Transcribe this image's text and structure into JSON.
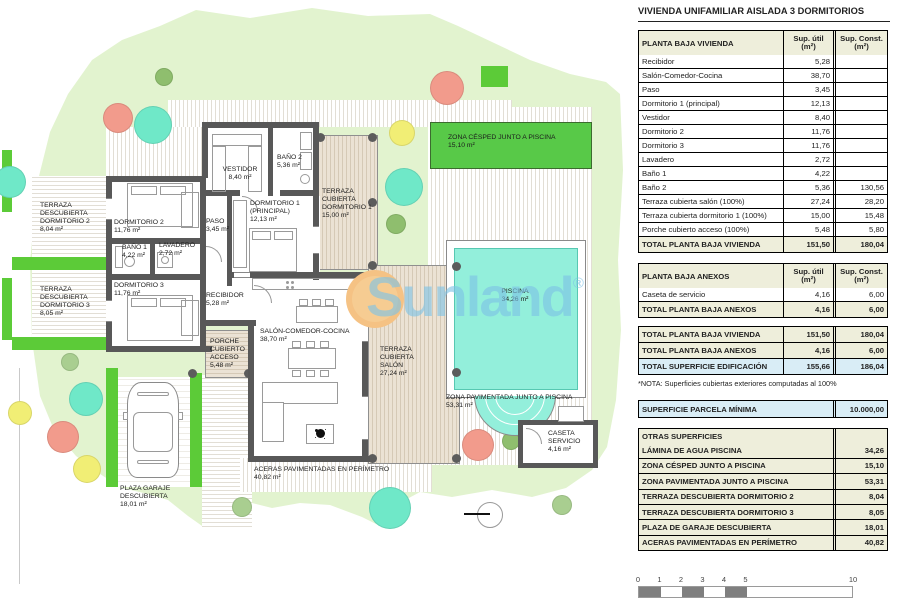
{
  "colors": {
    "garden_green": "#E2F3CF",
    "hedge_green": "#5CCB38",
    "cesped_green": "#58C948",
    "pool_aqua": "#93EFDB",
    "wall_gray": "#585858",
    "tree_salmon": "#F29B8C",
    "tree_teal": "#6FE8C8",
    "tree_yellow": "#F1EE75",
    "tree_green": "#8FBE6E",
    "tree_palegreen": "#A9CE90",
    "table_head_bg": "#EEEEDB",
    "table_highlight_bg": "#D9EDF6",
    "watermark_blue": "#7EC3E6",
    "watermark_orange": "#F6CC92",
    "scale_fill": "#7F7F7F"
  },
  "watermark": {
    "text": "Sunland",
    "reg": "®"
  },
  "plan": {
    "labels": {
      "terraza_desc_dorm2": {
        "name": "TERRAZA\nDESCUBIERTA\nDORMITORIO 2",
        "area": "8,04 m²"
      },
      "terraza_desc_dorm3": {
        "name": "TERRAZA\nDESCUBIERTA\nDORMITORIO 3",
        "area": "8,05 m²"
      },
      "dormitorio2": {
        "name": "DORMITORIO 2",
        "area": "11,76 m²"
      },
      "bano1": {
        "name": "BAÑO 1",
        "area": "4,22 m²"
      },
      "lavadero": {
        "name": "LAVADERO",
        "area": "2,72 m²"
      },
      "dormitorio3": {
        "name": "DORMITORIO 3",
        "area": "11,76 m²"
      },
      "vestidor": {
        "name": "VESTIDOR",
        "area": "8,40 m²"
      },
      "bano2": {
        "name": "BAÑO 2",
        "area": "5,36 m²"
      },
      "paso": {
        "name": "PASO",
        "area": "3,45 m²"
      },
      "dormitorio1": {
        "name": "DORMITORIO 1\n(PRINCIPAL)",
        "area": "12,13 m²"
      },
      "terraza_cub_dorm1": {
        "name": "TERRAZA\nCUBIERTA\nDORMITORIO 1",
        "area": "15,00 m²"
      },
      "recibidor": {
        "name": "RECIBIDOR",
        "area": "5,28 m²"
      },
      "salon": {
        "name": "SALÓN-COMEDOR-COCINA",
        "area": "38,70 m²"
      },
      "terraza_cub_salon": {
        "name": "TERRAZA\nCUBIERTA\nSALÓN",
        "area": "27,24 m²"
      },
      "porche": {
        "name": "PORCHE\nCUBIERTO\nACCESO",
        "area": "5,48 m²"
      },
      "plaza_garaje": {
        "name": "PLAZA GARAJE\nDESCUBIERTA",
        "area": "18,01 m²"
      },
      "aceras": {
        "name": "ACERAS PAVIMENTADAS EN PERÍMETRO",
        "area": "40,82 m²"
      },
      "zona_cesped": {
        "name": "ZONA CÉSPED JUNTO A PISCINA",
        "area": "15,10 m²"
      },
      "piscina": {
        "name": "PISCINA",
        "area": "34,26 m²"
      },
      "zona_pav": {
        "name": "ZONA PAVIMENTADA JUNTO A PISCINA",
        "area": "53,31 m²"
      },
      "caseta": {
        "name": "CASETA\nSERVICIO",
        "area": "4,16 m²"
      }
    }
  },
  "panel": {
    "title": "VIVIENDA UNIFAMILIAR AISLADA 3 DORMITORIOS",
    "col_util": "Sup. útil\n(m²)",
    "col_const": "Sup. Const.\n(m²)",
    "vivienda": {
      "header": "PLANTA BAJA VIVIENDA",
      "rows": [
        {
          "label": "Recibidor",
          "util": "5,28",
          "const": ""
        },
        {
          "label": "Salón-Comedor-Cocina",
          "util": "38,70",
          "const": ""
        },
        {
          "label": "Paso",
          "util": "3,45",
          "const": ""
        },
        {
          "label": "Dormitorio 1 (principal)",
          "util": "12,13",
          "const": ""
        },
        {
          "label": "Vestidor",
          "util": "8,40",
          "const": ""
        },
        {
          "label": "Dormitorio 2",
          "util": "11,76",
          "const": ""
        },
        {
          "label": "Dormitorio 3",
          "util": "11,76",
          "const": ""
        },
        {
          "label": "Lavadero",
          "util": "2,72",
          "const": ""
        },
        {
          "label": "Baño 1",
          "util": "4,22",
          "const": ""
        },
        {
          "label": "Baño 2",
          "util": "5,36",
          "const": "130,56"
        },
        {
          "label": "Terraza cubierta salón (100%)",
          "util": "27,24",
          "const": "28,20"
        },
        {
          "label": "Terraza cubierta dormitorio 1 (100%)",
          "util": "15,00",
          "const": "15,48"
        },
        {
          "label": "Porche cubierto acceso (100%)",
          "util": "5,48",
          "const": "5,80"
        }
      ],
      "total": {
        "label": "TOTAL PLANTA BAJA VIVIENDA",
        "util": "151,50",
        "const": "180,04"
      }
    },
    "anexos": {
      "header": "PLANTA BAJA ANEXOS",
      "rows": [
        {
          "label": "Caseta de servicio",
          "util": "4,16",
          "const": "6,00"
        }
      ],
      "total": {
        "label": "TOTAL PLANTA BAJA ANEXOS",
        "util": "4,16",
        "const": "6,00"
      }
    },
    "resumen": [
      {
        "label": "TOTAL PLANTA BAJA VIVIENDA",
        "util": "151,50",
        "const": "180,04",
        "highlight": false
      },
      {
        "label": "TOTAL PLANTA BAJA ANEXOS",
        "util": "4,16",
        "const": "6,00",
        "highlight": false
      },
      {
        "label": "TOTAL SUPERFICIE EDIFICACIÓN",
        "util": "155,66",
        "const": "186,04",
        "highlight": true
      }
    ],
    "nota": "*NOTA: Superficies cubiertas exteriores computadas al 100%",
    "parcela": {
      "label": "SUPERFICIE PARCELA MÍNIMA",
      "value": "10.000,00"
    },
    "otras": {
      "header": "OTRAS SUPERFICIES",
      "rows": [
        {
          "label": "LÁMINA DE AGUA PISCINA",
          "value": "34,26"
        },
        {
          "label": "ZONA CÉSPED JUNTO A PISCINA",
          "value": "15,10"
        },
        {
          "label": "ZONA PAVIMENTADA JUNTO A PISCINA",
          "value": "53,31"
        },
        {
          "label": "TERRAZA DESCUBIERTA DORMITORIO 2",
          "value": "8,04"
        },
        {
          "label": "TERRAZA DESCUBIERTA DORMITORIO 3",
          "value": "8,05"
        },
        {
          "label": "PLAZA DE GARAJE DESCUBIERTA",
          "value": "18,01"
        },
        {
          "label": "ACERAS PAVIMENTADAS EN PERÍMETRO",
          "value": "40,82"
        }
      ]
    },
    "scale": {
      "ticks": [
        "0",
        "1",
        "2",
        "3",
        "4",
        "5",
        "10"
      ],
      "caption": "ESCALA GRÁFICA (METROS)"
    }
  }
}
